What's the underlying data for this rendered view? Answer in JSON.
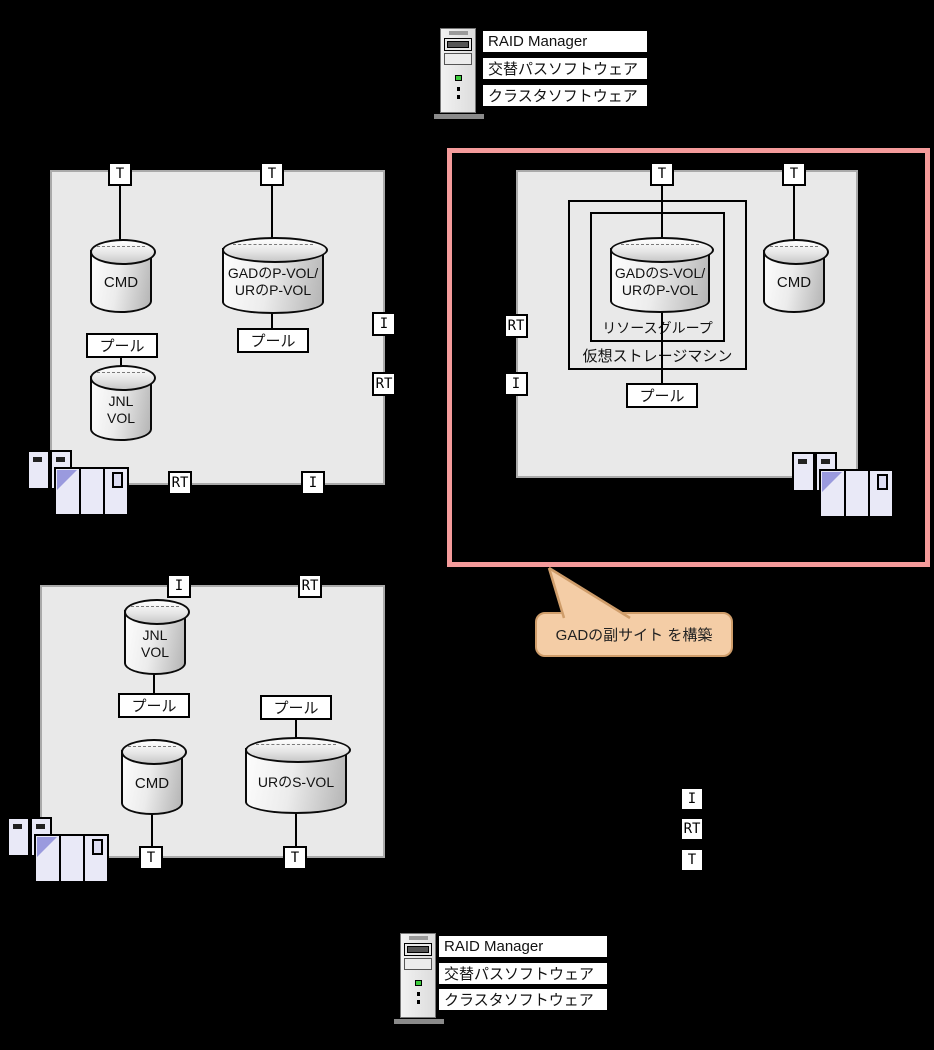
{
  "colors": {
    "page_bg": "#000000",
    "system_box_fill": "#e9e9e9",
    "system_box_border": "#aaaaaa",
    "highlight_border": "#f59b9b",
    "callout_fill": "#f4cda6",
    "callout_border": "#cf9d6a"
  },
  "servers": {
    "top": {
      "software": [
        "RAID Manager",
        "交替パスソフトウェア",
        "クラスタソフトウェア"
      ]
    },
    "bottom": {
      "software": [
        "RAID Manager",
        "交替パスソフトウェア",
        "クラスタソフトウェア"
      ]
    }
  },
  "port_labels": {
    "target": "T",
    "initiator": "I",
    "rcu_target": "RT"
  },
  "shared_labels": {
    "pool": "プール",
    "cmd": "CMD",
    "jnl_line1": "JNL",
    "jnl_line2": "VOL"
  },
  "primary_site": {
    "gad_pvol_line1": "GADのP-VOL/",
    "gad_pvol_line2": "URのP-VOL"
  },
  "gad_secondary_site": {
    "gad_svol_line1": "GADのS-VOL/",
    "gad_svol_line2": "URのP-VOL",
    "vsm_label": "仮想ストレージマシン",
    "rg_label": "リソースグループ"
  },
  "ur_secondary_site": {
    "ur_svol": "URのS-VOL"
  },
  "callout": {
    "text": "GADの副サイト を構築"
  },
  "legend": {
    "items": [
      "I",
      "RT",
      "T"
    ]
  }
}
